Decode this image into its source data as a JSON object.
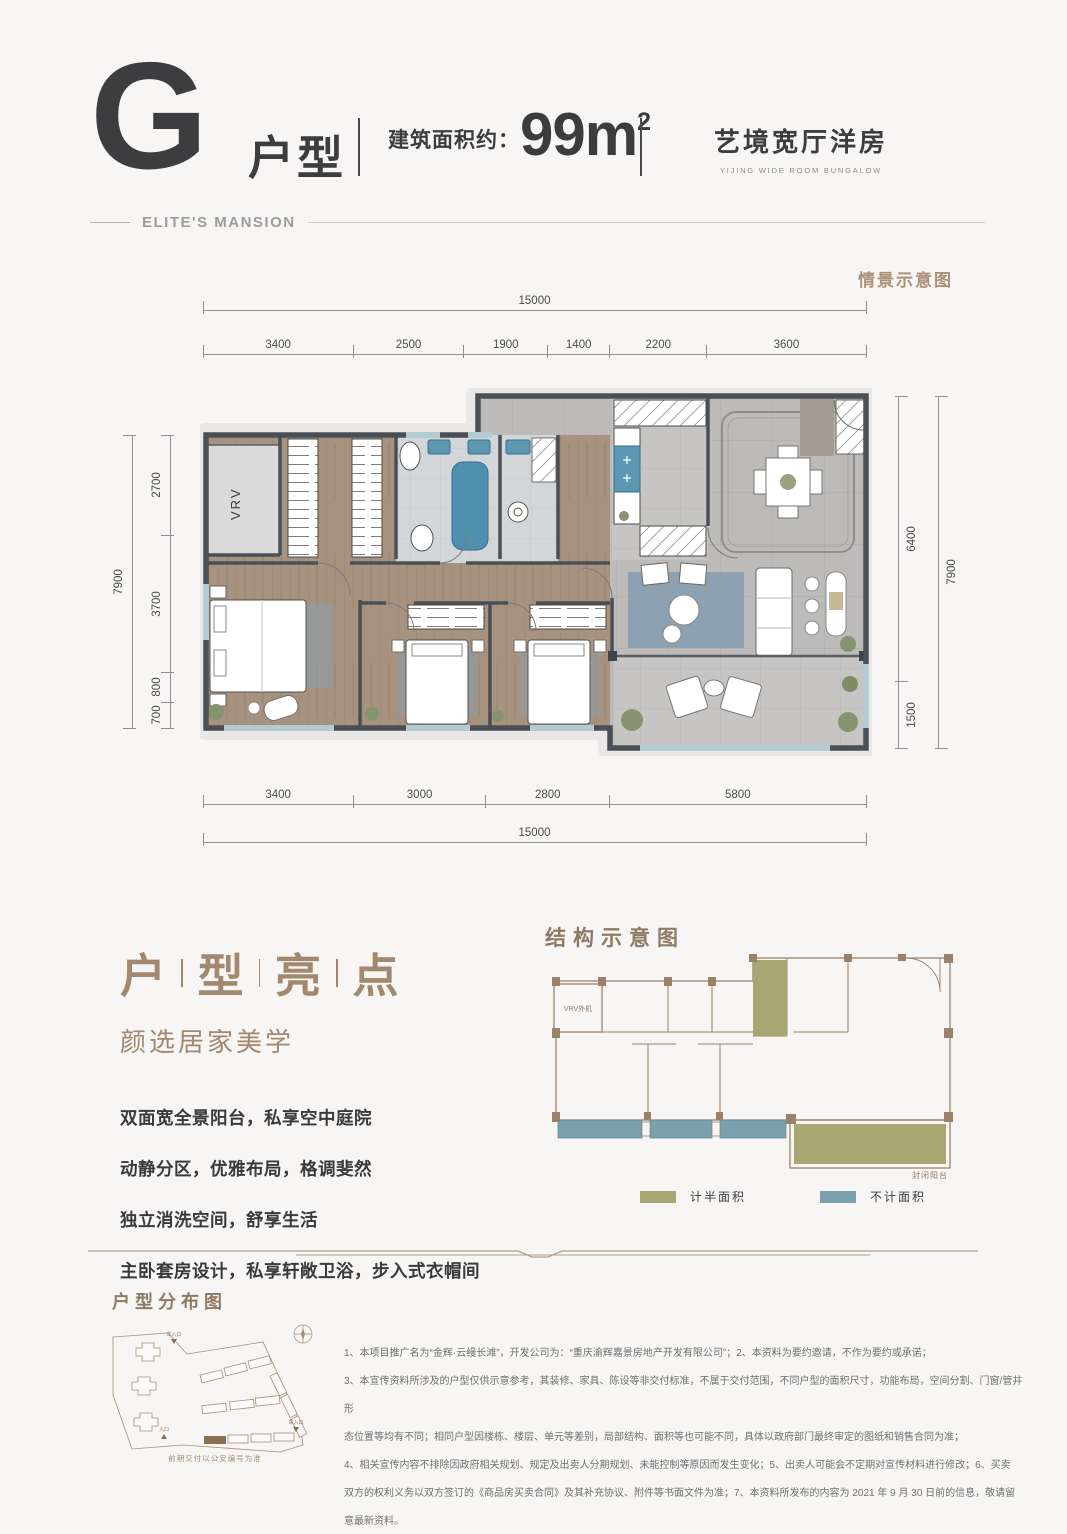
{
  "header": {
    "type_letter": "G",
    "type_label": "户型",
    "area_label": "建筑面积约：",
    "area_value": "99m",
    "area_sup": "2",
    "tagline": "艺境宽厅洋房",
    "tagline_en": "YIJING WIDE ROOM BUNGALOW",
    "brand": "ELITE'S MANSION"
  },
  "plan": {
    "scene_note": "情景示意图",
    "vrv_label": "VRV",
    "dims": {
      "top_total": "15000",
      "top_segments": [
        "3400",
        "2500",
        "1900",
        "1400",
        "2200",
        "3600"
      ],
      "left_total": "7900",
      "left_segments": [
        "2700",
        "3700",
        "800",
        "700"
      ],
      "right_segments": [
        "6400",
        "1500"
      ],
      "right_total": "7900",
      "bottom_segments": [
        "3400",
        "3000",
        "2800",
        "5800"
      ],
      "bottom_total": "15000"
    }
  },
  "highlights": {
    "title_chars": [
      "户",
      "型",
      "亮",
      "点"
    ],
    "subtitle": "颜选居家美学",
    "items": [
      "双面宽全景阳台，私享空中庭院",
      "动静分区，优雅布局，格调斐然",
      "独立消洗空间，舒享生活",
      "主卧套房设计，私享轩敞卫浴，步入式衣帽间"
    ]
  },
  "structure": {
    "title": "结构示意图",
    "vrv_label": "VRV外机",
    "balcony_label": "封闭阳台",
    "legend": [
      {
        "label": "计半面积",
        "color": "#a8a672"
      },
      {
        "label": "不计面积",
        "color": "#7ba1af"
      }
    ]
  },
  "distribution": {
    "title": "户型分布图",
    "caption": "前期交付以公安编号为准",
    "entries": [
      "车入口",
      "入口",
      "车入口"
    ]
  },
  "disclaimer": {
    "lines": [
      "1、本项目推广名为“金辉·云缦长滩”，开发公司为：“重庆渝辉嘉景房地产开发有限公司”；2、本资料为要约邀请，不作为要约或承诺；",
      "3、本宣传资料所涉及的户型仅供示意参考，其装修、家具、陈设等非交付标准，不属于交付范围，不同户型的面积尺寸，功能布局，空间分割、门窗/管井形",
      "态位置等均有不同；相同户型因楼栋、楼层、单元等差别，局部结构、面积等也可能不同，具体以政府部门最终审定的图纸和销售合同为准；",
      "4、相关宣传内容不排除因政府相关规划、规定及出卖人分期规划、未能控制等原因而发生变化；5、出卖人可能会不定期对宣传材料进行修改；6、买卖",
      "双方的权利义务以双方签订的《商品房买卖合同》及其补充协议、附件等书面文件为准；7、本资料所发布的内容为 2021 年 9 月 30 日前的信息，敬请留意最新资料。"
    ]
  },
  "colors": {
    "accent_brown": "#ab9078",
    "dark_text": "#3d3d3f",
    "half_area": "#a8a672",
    "no_count_area": "#7ba1af",
    "wall": "#4a4f55"
  }
}
